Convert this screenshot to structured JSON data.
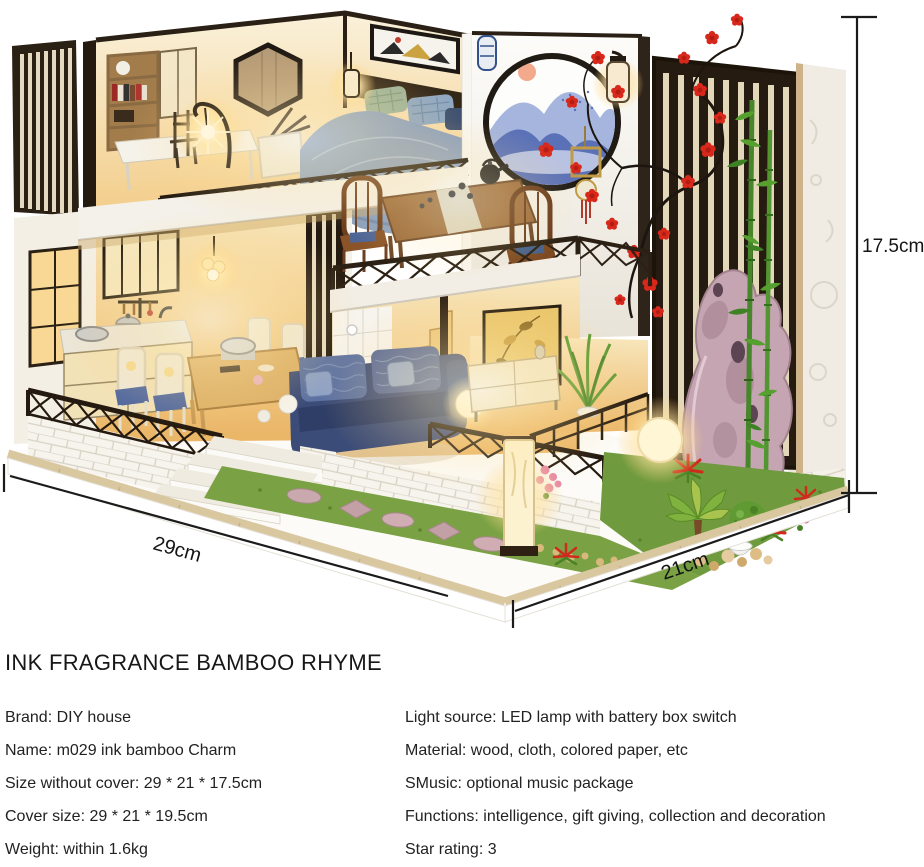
{
  "title": "INK FRAGRANCE BAMBOO RHYME",
  "dimensions": {
    "height": "17.5cm",
    "width": "29cm",
    "depth": "21cm"
  },
  "specs": {
    "left": [
      "Brand: DIY house",
      "Name: m029 ink bamboo Charm",
      "Size without cover: 29 * 21 * 17.5cm",
      "Cover size: 29 * 21 * 19.5cm",
      "Weight: within 1.6kg"
    ],
    "right": [
      "Light source: LED lamp with battery box switch",
      "Material: wood, cloth, colored paper, etc",
      "SMusic: optional music package",
      "Functions: intelligence, gift giving, collection and decoration",
      "Star rating: 3"
    ]
  },
  "illustration_colors": {
    "dark_wood_trim": "#2a2016",
    "cream_slat": "#e6dbc2",
    "warm_light": "#ffe9ad",
    "blossom_red": "#d7281b",
    "bamboo_green": "#56a030",
    "sofa_navy": "#3c4c78",
    "mountain_blue": "#5a71b8",
    "grass_green": "#7aa244",
    "rock_pink": "#c5a5b1",
    "annotation_black": "#1b1b1b"
  }
}
